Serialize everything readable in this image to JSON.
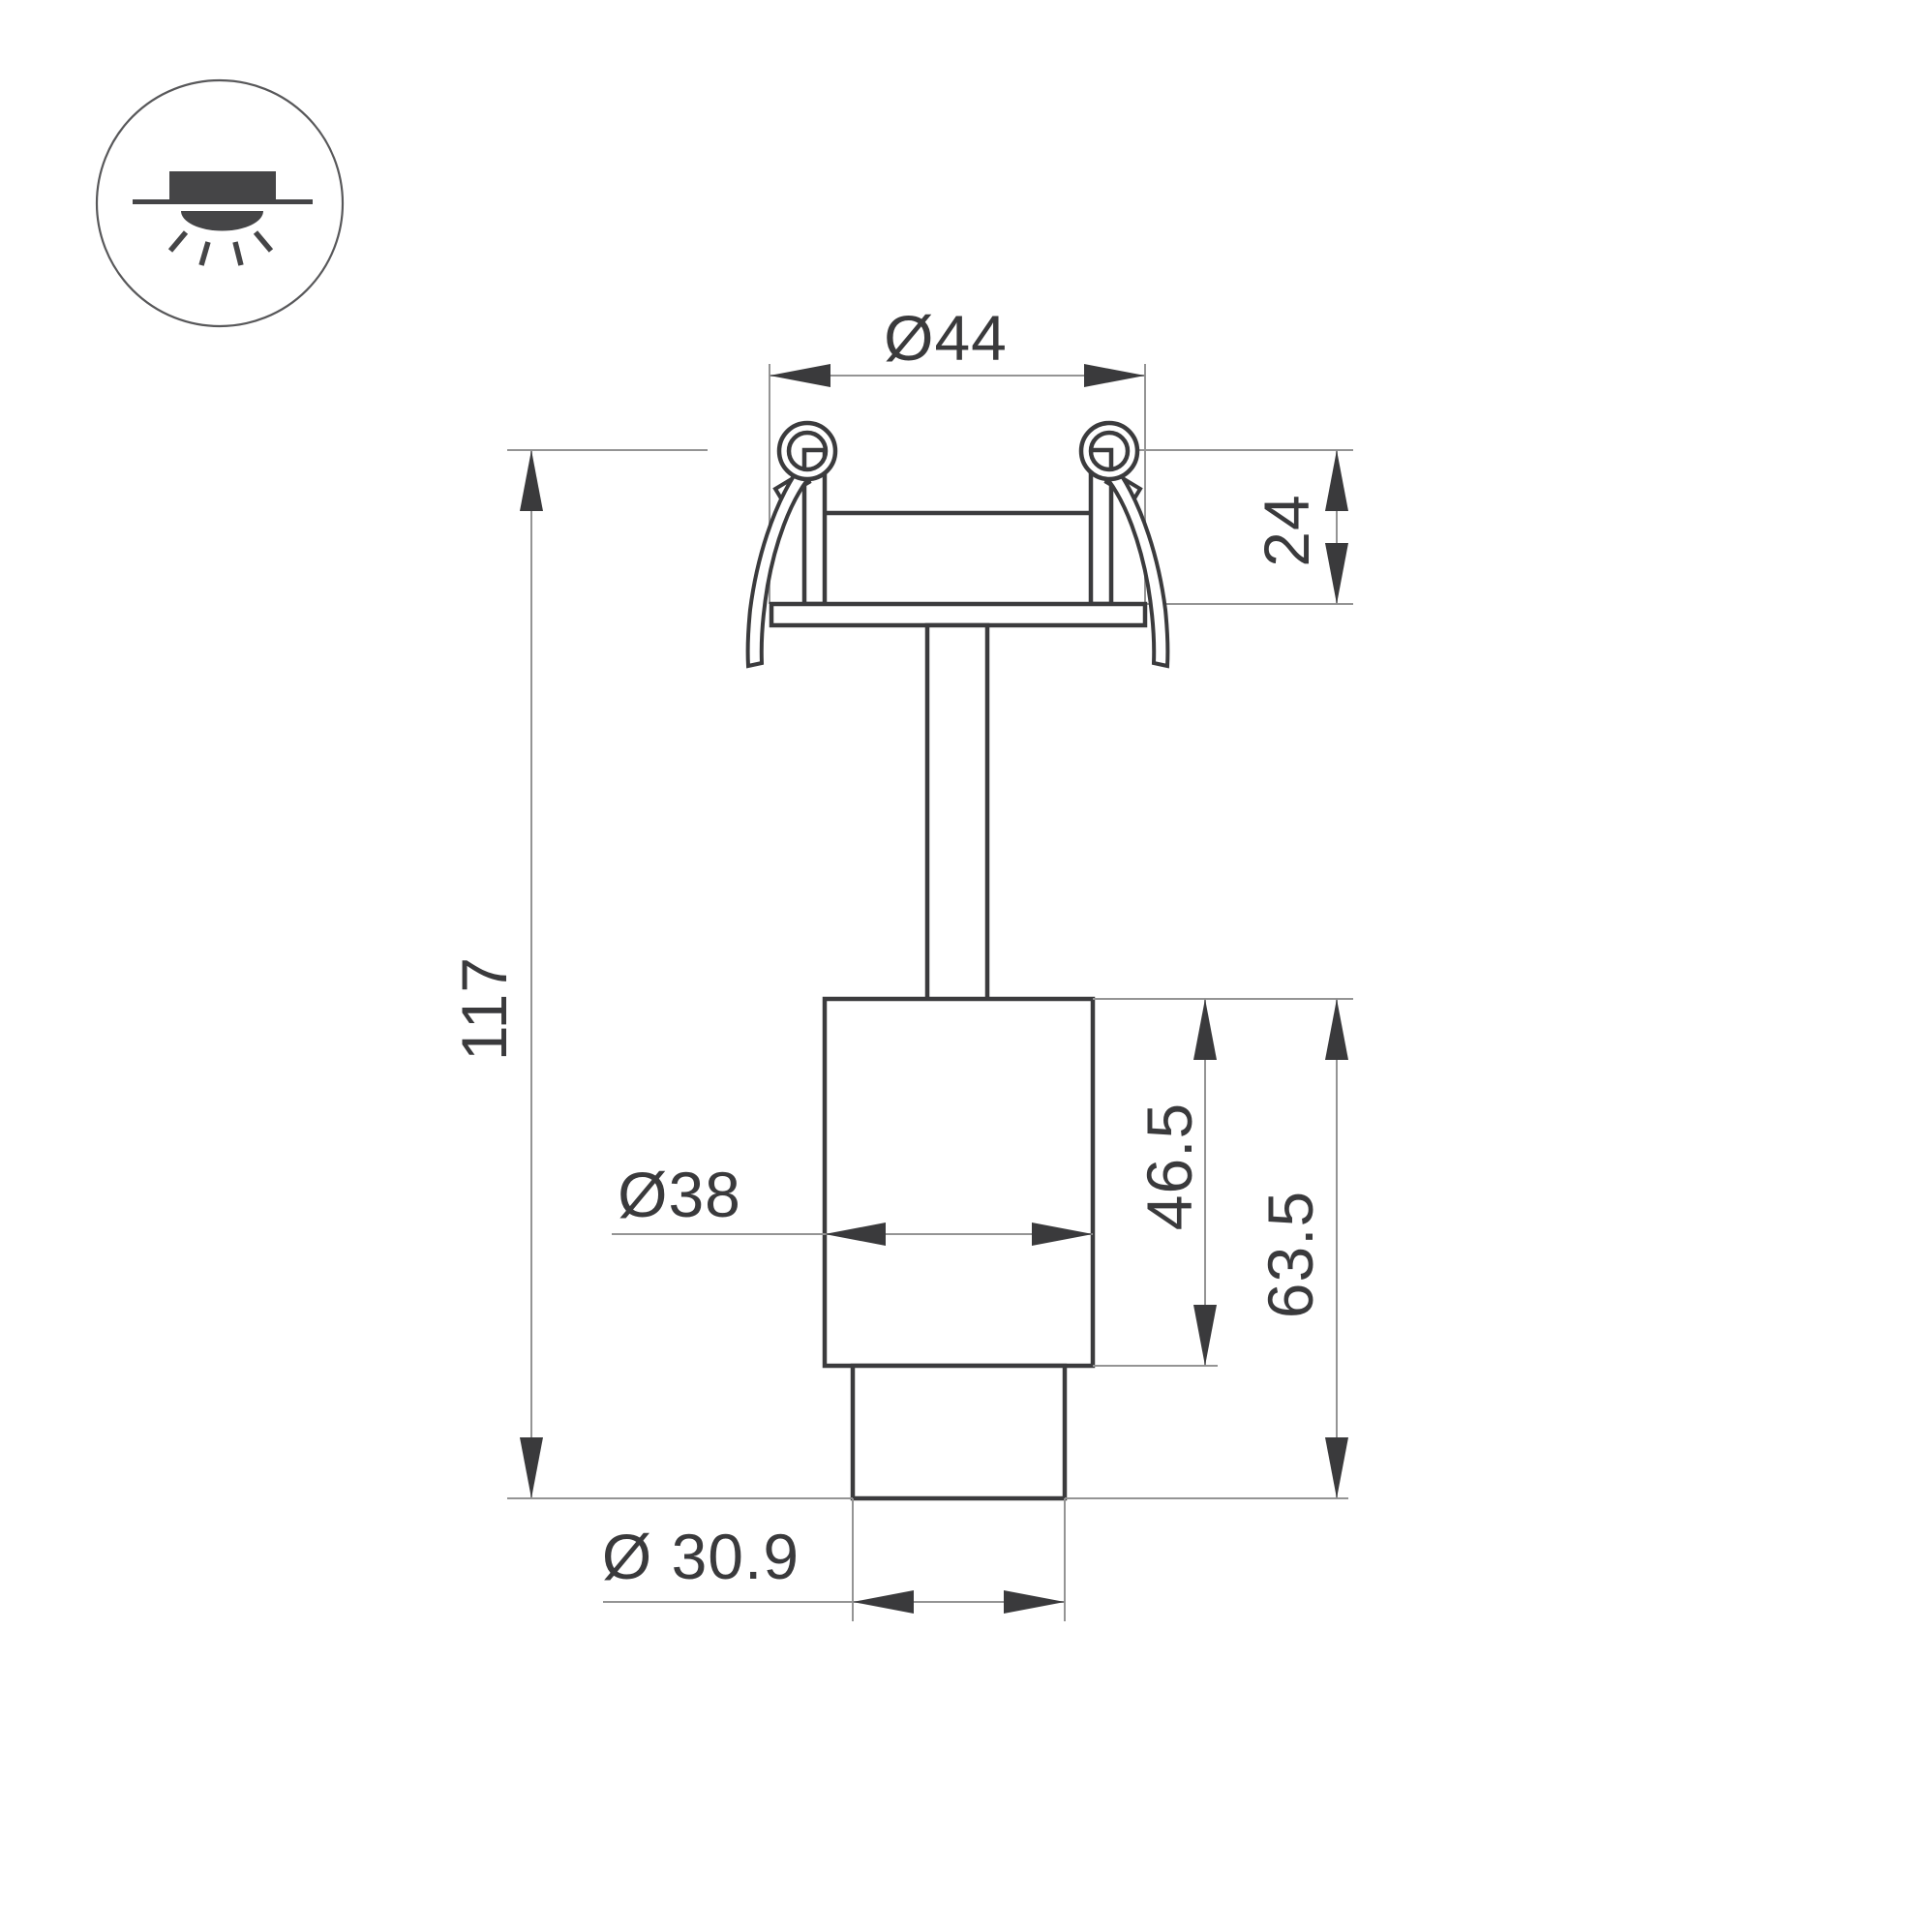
{
  "colors": {
    "outline": "#3b3b3d",
    "dimline": "#949494",
    "textcolor": "#3a3a3c",
    "iconfill": "#454547",
    "background": "#ffffff"
  },
  "icon": {
    "name": "recessed-downlight-icon"
  },
  "dimensions": {
    "cutout_diameter": {
      "label": "Ø44",
      "value_mm": 44
    },
    "recess_depth": {
      "label": "24",
      "value_mm": 24
    },
    "overall_height": {
      "label": "117",
      "value_mm": 117
    },
    "body_diameter": {
      "label": "Ø38",
      "value_mm": 38
    },
    "body_height": {
      "label": "46.5",
      "value_mm": 46.5
    },
    "below_ceiling_height": {
      "label": "63.5",
      "value_mm": 63.5
    },
    "tube_diameter": {
      "label": "Ø 30.9",
      "value_mm": 30.9
    }
  }
}
